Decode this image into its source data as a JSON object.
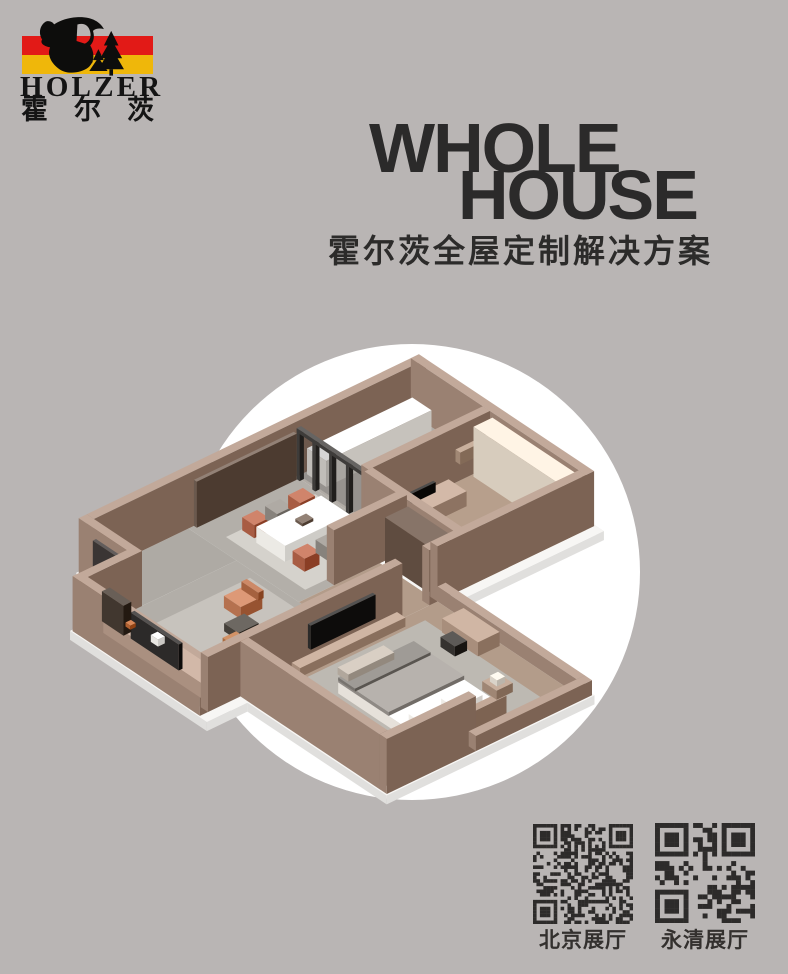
{
  "poster": {
    "background": "#b9b5b4"
  },
  "logo": {
    "name": "HOLZER",
    "name_cn": "霍尔茨",
    "stripe_red": "#e21a17",
    "stripe_yellow": "#efb70a",
    "mark": "lumberjack-with-axe-and-fir-trees"
  },
  "title": {
    "en_line1": "WHOLE",
    "en_line2": "HOUSE",
    "cn": "霍尔茨全屋定制解决方案",
    "color": "#2b2a2a"
  },
  "hero": {
    "circle_color": "#ffffff",
    "render": "isometric-apartment-cutaway"
  },
  "qr_codes": [
    {
      "label": "北京展厅"
    },
    {
      "label": "永清展厅"
    }
  ]
}
